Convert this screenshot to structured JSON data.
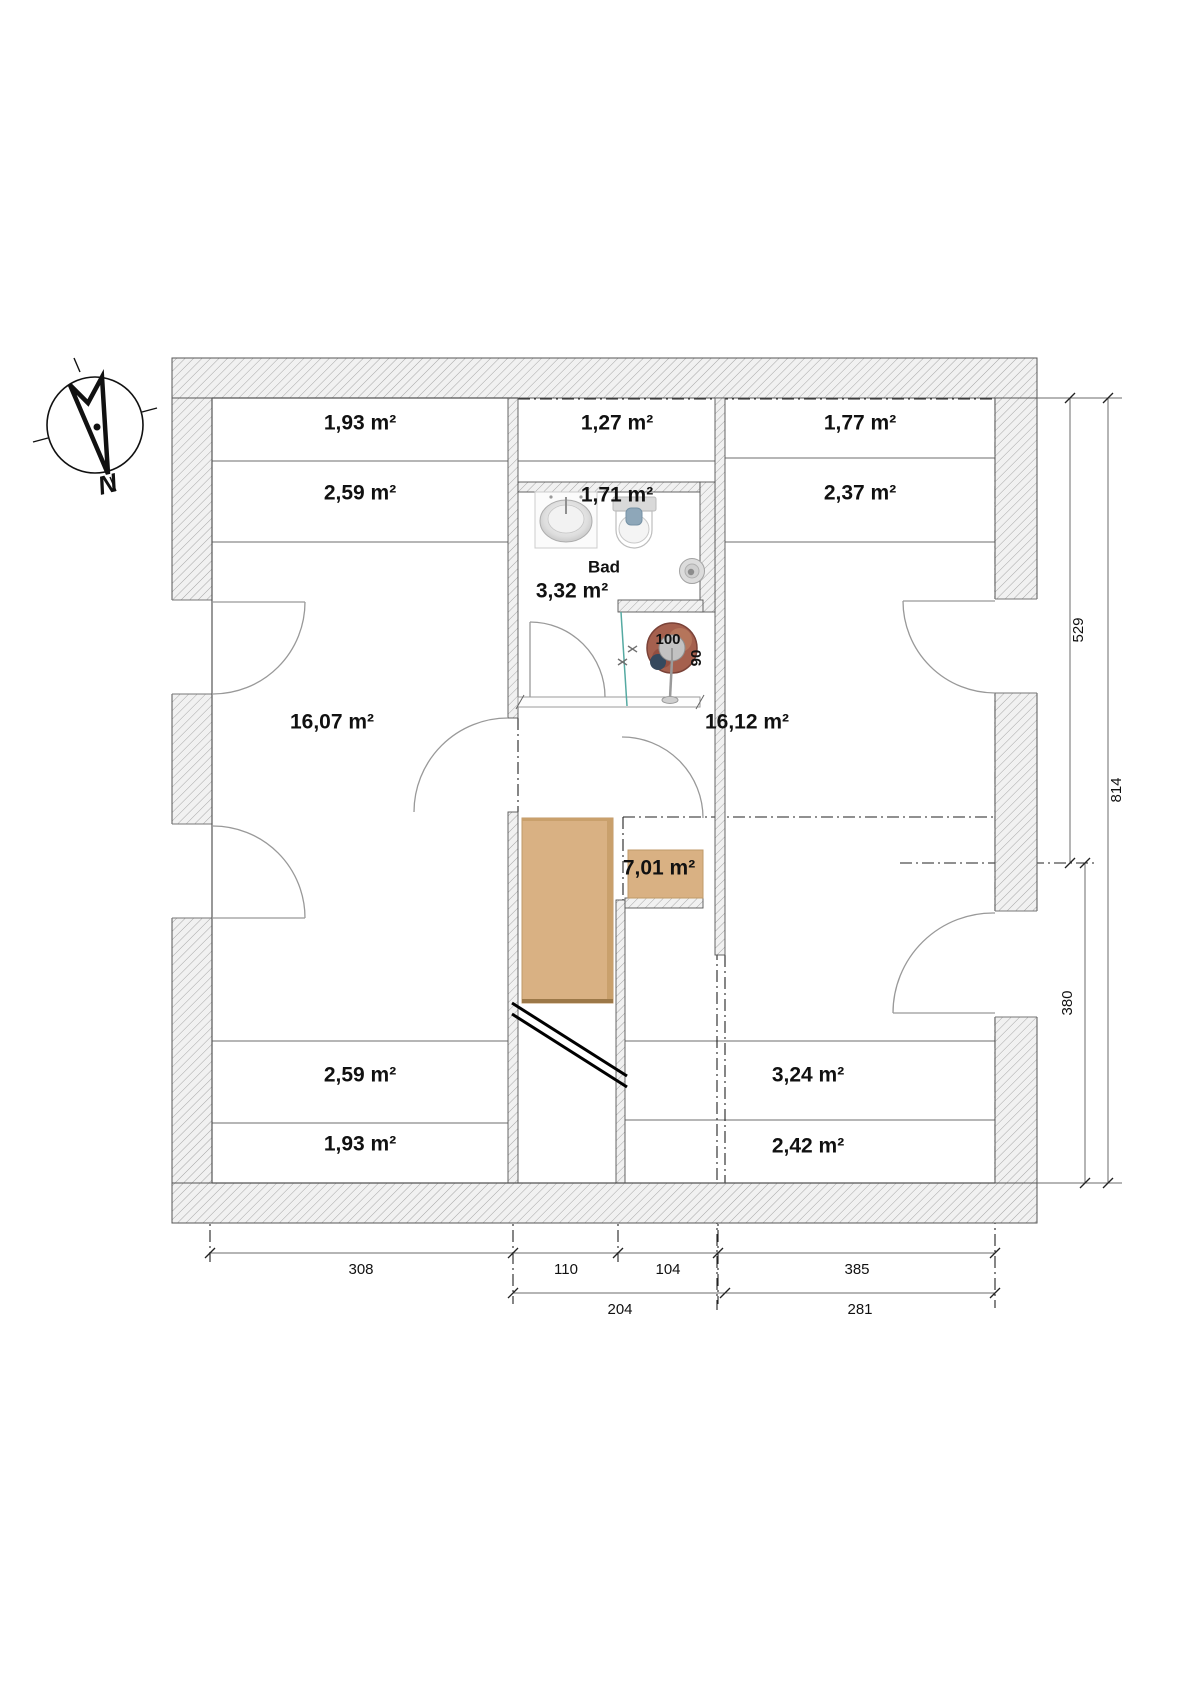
{
  "compass": {
    "north": "N"
  },
  "labels": {
    "strip_tl_1": "1,93 m²",
    "strip_tl_2": "2,59 m²",
    "strip_tm_1": "1,27 m²",
    "strip_tm_2": "1,71 m²",
    "bath_name": "Bad",
    "bath_area": "3,32 m²",
    "strip_tr_1": "1,77 m²",
    "strip_tr_2": "2,37 m²",
    "room_left": "16,07 m²",
    "room_right": "16,12 m²",
    "hall": "7,01 m²",
    "strip_bl_1": "2,59 m²",
    "strip_bl_2": "1,93 m²",
    "strip_br_1": "3,24 m²",
    "strip_br_2": "2,42 m²",
    "shower_width": "100",
    "shower_depth": "90"
  },
  "dimensions": {
    "bottom_row1": [
      "308",
      "110",
      "104",
      "385"
    ],
    "bottom_row2": [
      "204",
      "281"
    ],
    "right_col": [
      "529",
      "814",
      "380"
    ]
  },
  "colors": {
    "stairs_wood": "#d9b183",
    "stairs_edge": "#9c7848",
    "hatch_bg": "#f1f1f1",
    "hatch_line": "#a6a6a6",
    "teal_marker": "#55aaa2",
    "toilet_seat": "#8ea7b9"
  }
}
